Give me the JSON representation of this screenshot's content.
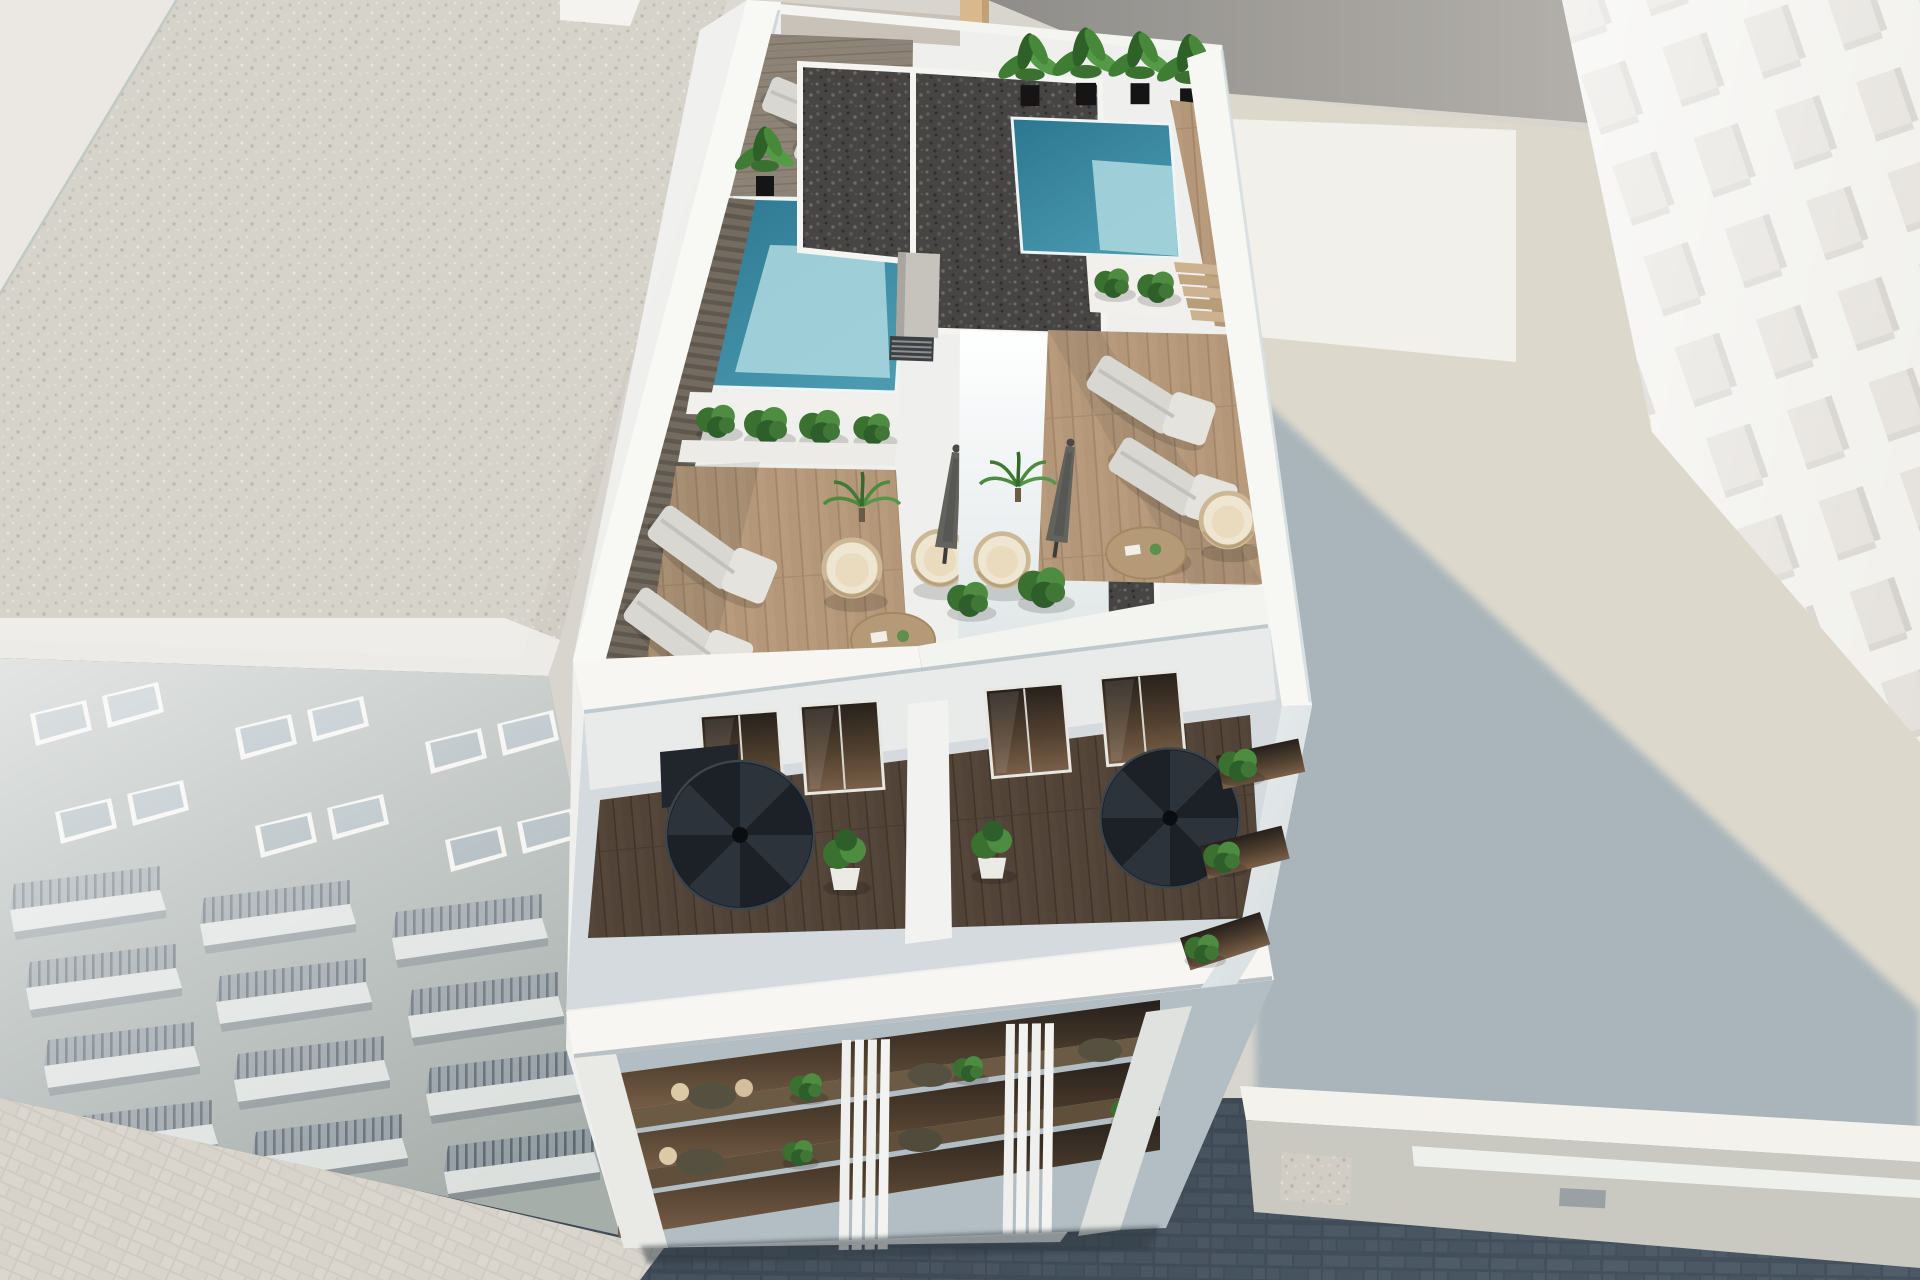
{
  "scene": {
    "description": "Aerial 3D architectural rendering of a modern white apartment building rooftop with two plunge pools, wooden deck terraces, sun loungers, rattan hanging chairs, closed parasols, potted plants and twin black spiral staircases, flanked by a gravel-roofed neighbouring block on the left, a pale high-rise on the right, a sunlit courtyard with a long cast shadow, and a dark cobbled street below.",
    "style": "photorealistic CGI visualisation",
    "view": "high aerial oblique view looking down at the rooftop",
    "lighting": "bright midday sun, long blue-grey shadow cast to the lower right"
  },
  "objects": {
    "left_building": "Neighbouring building with light gravel flat roof",
    "left_roof": "Light gravel flat roof",
    "left_parapet": "White roof parapet band",
    "left_facade": "Hazy facade with window pairs and balcony rows",
    "pavement": "Sunlit block pavement at the street corner",
    "street": "Dark cobbled street in shadow",
    "annex": "Low white building along the street",
    "right_ground": "Sunlit courtyard ground",
    "ground_shadow": "Long building shadow on the courtyard",
    "right_tower": "Pale high-rise with grid of recessed windows",
    "back_wall": "Grey party wall behind the rooftop",
    "main_building": "New-build white apartment block",
    "pool_left": "Left rooftop plunge pool",
    "pool_right": "Right rooftop plunge pool",
    "dark_roof": "Dark gravel roof strips of the stair core",
    "stair_core": "White rooftop stair and lift core",
    "louver_vent": "Dark louvered vent",
    "planter": "White planter with green shrubs",
    "plant_row_left": "Row of potted banana plants beside the left pool",
    "plant_row_right": "Row of potted banana plants beside the right pool",
    "terrace_left": "Left roof terrace with timber decking",
    "terrace_right": "Right roof terrace with timber decking",
    "sun_lounger": "Sun lounger",
    "hanging_chair": "Rattan hanging egg chair",
    "coffee_table": "Round wooden coffee table",
    "umbrella": "Closed parasol",
    "palm": "Small potted palm",
    "bush": "Green shrub",
    "spiral_stair": "Black spiral staircase",
    "glass_door": "Dark glazed terrace door",
    "lower_terraces": "Recessed private terraces with dark timber decking",
    "front_parapet": "Sunlit white parapet band",
    "facade": "Street facade with glazed balconies",
    "fins": "Vertical white louvre fins",
    "side_balconies": "Side balconies with plants",
    "deck_steps": "Timber steps beside the right pool",
    "pool_walkway": "Slatted walkway along the west parapet"
  },
  "palette": {
    "white_sunlit": "#f7f6f2",
    "white_shade": "#cfd8dc",
    "pool_deep": "#2b7790",
    "pool_shallow": "#a8d6de",
    "gravel_light": "#d2cec5",
    "gravel_dark": "#454442",
    "wood_light": "#b79b7c",
    "wood_dark": "#55463a",
    "foliage": "#3f7d35",
    "street": "#46525e",
    "shadow": "#a7b4ba",
    "ground": "#ddd8cc"
  },
  "counts": {
    "pools": 2,
    "sun_loungers": 6,
    "hanging_chairs": 4,
    "coffee_tables": 2,
    "umbrellas": 2,
    "spiral_staircases": 2
  }
}
